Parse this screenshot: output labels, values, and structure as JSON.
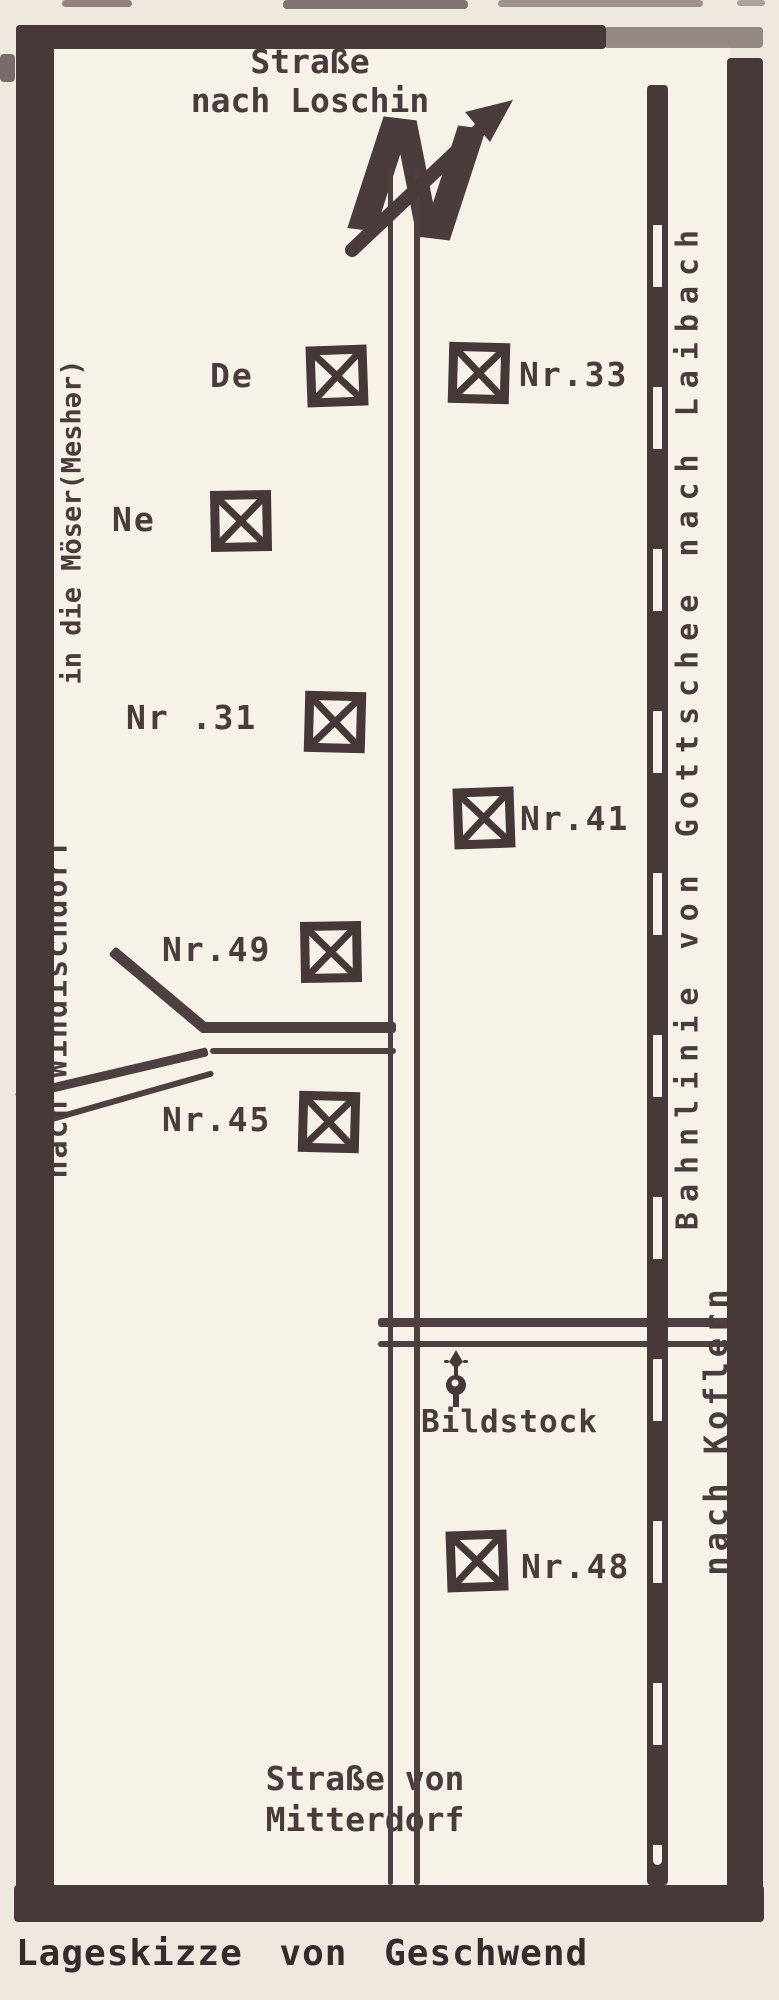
{
  "caption": "Lageskizze von Geschwend",
  "map": {
    "north_indicator": "N",
    "roads": {
      "top_line1": "Straße",
      "top_line2": "nach Loschin",
      "bottom_line1": "Straße von",
      "bottom_line2": "Mitterdorf",
      "west_upper": "in die Möser(Meshər)",
      "west_lower": "nach Windischdorf",
      "east": "nach Koflern"
    },
    "railway": {
      "label": "Bahnlinie von Gottschee nach Laibach"
    },
    "landmark": {
      "label": "Bildstock"
    },
    "buildings": [
      {
        "label": "De"
      },
      {
        "label": "Nr.33"
      },
      {
        "label": "Ne"
      },
      {
        "label": "Nr .31"
      },
      {
        "label": "Nr.41"
      },
      {
        "label": "Nr.49"
      },
      {
        "label": "Nr.45"
      },
      {
        "label": "Nr.48"
      }
    ],
    "colors": {
      "ink": "#4a3b3d",
      "paper": "#efe8de",
      "map_bg": "#f7f2e8"
    }
  }
}
